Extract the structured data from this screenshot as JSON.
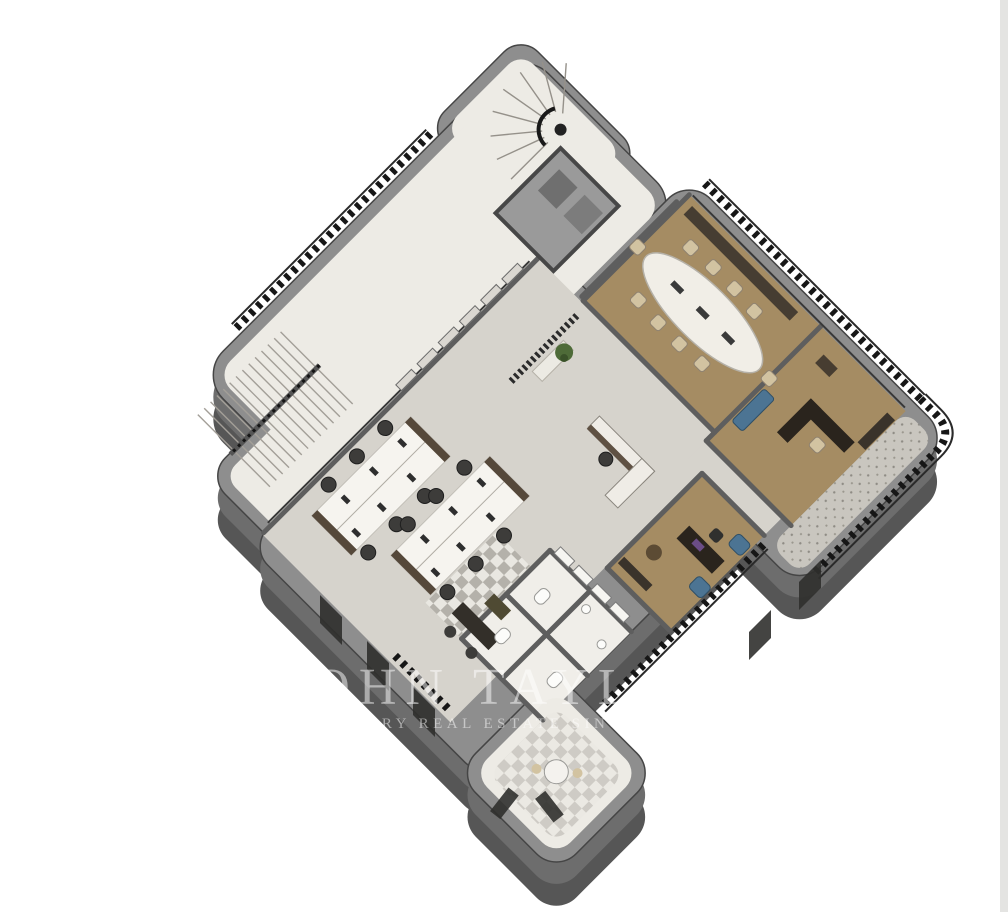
{
  "image": {
    "type": "3d-floor-plan-rendering",
    "view": "axonometric cutaway, plan rotated 45 degrees",
    "subject": "office floor of a residential-style building"
  },
  "watermark": {
    "brand": "JOHN TAYLOR",
    "tagline": "LUXURY REAL ESTATE SINCE 1864"
  },
  "colors": {
    "wall_top": "#8e8e8e",
    "wall_mid": "#6d6d6d",
    "wall_side": "#565656",
    "wall_line": "#454545",
    "int_wall": "#5e5e5e",
    "floor_white": "#edebe5",
    "floor_concrete": "#d6d3cc",
    "floor_base": "#dcd9d3",
    "wood": "#a58c63",
    "terrace": "#c9c6bf",
    "railing": "#161616",
    "chair_beige": "#d2c3a1",
    "sofa_blue": "#4c7493",
    "desk_dark": "#2a241d",
    "desk_white": "#f6f4ef",
    "plant_green": "#4e6b38",
    "purple_accent": "#6b4d86",
    "canvas_bg": "#ffffff",
    "edge_strip": "#e4e4e2",
    "watermark": "rgba(255,255,255,0.5)"
  },
  "rooms": [
    {
      "name": "stair-tower",
      "floor": "white stone",
      "features": [
        "curved winder staircase",
        "dark balustrade",
        "rounded exterior corner"
      ]
    },
    {
      "name": "elevator-core",
      "floor": "grey",
      "features": [
        "lift shaft walls"
      ]
    },
    {
      "name": "conference-room",
      "floor": "wood",
      "features": [
        "oval white table",
        "10 beige chairs",
        "media credenza",
        "juliet railing on glazed wall"
      ]
    },
    {
      "name": "executive-office",
      "floor": "wood",
      "features": [
        "dark L-shaped desk",
        "beige task chair",
        "blue sofa",
        "sideboard"
      ]
    },
    {
      "name": "right-terrace",
      "floor": "speckled stone",
      "features": [
        "black baluster railing",
        "rounded corner"
      ]
    },
    {
      "name": "private-office",
      "floor": "wood",
      "features": [
        "dark desk with purple accessory",
        "two blue armchairs",
        "leather pouf",
        "railing to terrace"
      ]
    },
    {
      "name": "open-office",
      "floor": "concrete",
      "features": [
        "two white bench desk clusters",
        "12 dark task chairs",
        "monitors",
        "reception L-desk",
        "plant",
        "slatted partition with white bench"
      ]
    },
    {
      "name": "left-staircase",
      "floor": "white stone",
      "features": [
        "switchback flights",
        "dark handrail"
      ]
    },
    {
      "name": "west-balcony",
      "floor": "white stone",
      "features": [
        "black baluster railing along facade"
      ]
    },
    {
      "name": "wc-block",
      "floor": "white tile with checker border",
      "features": [
        "toilets",
        "washbasins",
        "window band"
      ]
    },
    {
      "name": "south-rotunda",
      "floor": "checker tile",
      "features": [
        "round table",
        "rounded bay facade windows"
      ]
    },
    {
      "name": "small-meeting-nook",
      "floor": "concrete",
      "features": [
        "dark desk",
        "two chairs"
      ]
    }
  ]
}
